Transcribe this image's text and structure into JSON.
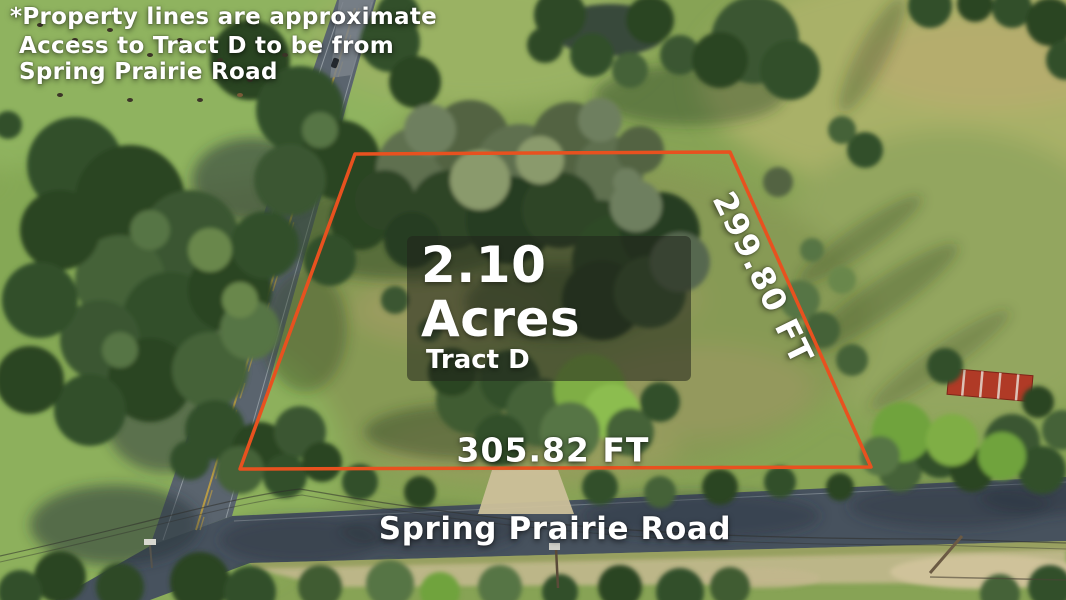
{
  "overlay": {
    "disclaimer": "*Property lines are approximate",
    "access_note": [
      "Access to Tract D to be from",
      "Spring Prairie Road"
    ]
  },
  "parcel": {
    "acreage": "2.10 Acres",
    "tract": "Tract D",
    "side_right": "299.80 FT",
    "side_bottom": "305.82 FT"
  },
  "road": {
    "name": "Spring Prairie Road"
  },
  "colors": {
    "boundary_line": "#e8511f",
    "label_text": "#ffffff",
    "label_bg": "rgba(33,36,28,0.55)"
  }
}
